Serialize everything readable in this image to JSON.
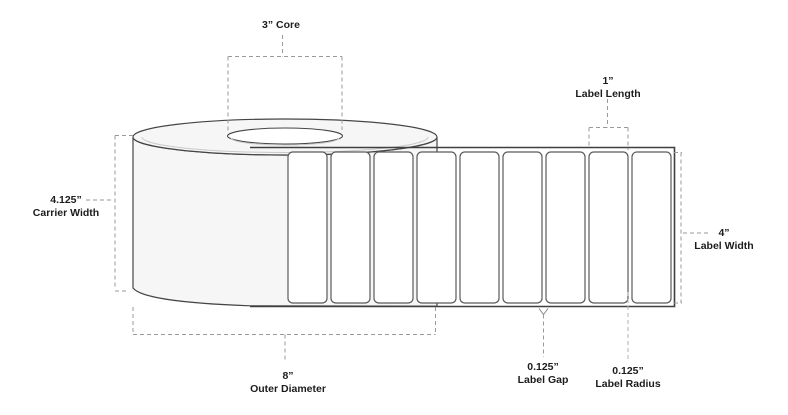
{
  "diagram_title": "label-roll-specification-diagram",
  "annotations": {
    "core": {
      "value": "3” Core"
    },
    "carrier_width": {
      "value": "4.125”",
      "label": "Carrier Width"
    },
    "label_length": {
      "value": "1”",
      "label": "Label Length"
    },
    "label_width": {
      "value": "4”",
      "label": "Label Width"
    },
    "outer_diameter": {
      "value": "8”",
      "label": "Outer Diameter"
    },
    "label_gap": {
      "value": "0.125”",
      "label": "Label Gap"
    },
    "label_radius": {
      "value": "0.125”",
      "label": "Label Radius"
    }
  },
  "roll": {
    "label_count": 9
  },
  "colors": {
    "background": "#ffffff",
    "outline": "#454545",
    "roll_fill": "#f6f6f6",
    "label_fill": "#ffffff",
    "dash_gray": "#9a9a9a",
    "text": "#1c1c1c"
  }
}
